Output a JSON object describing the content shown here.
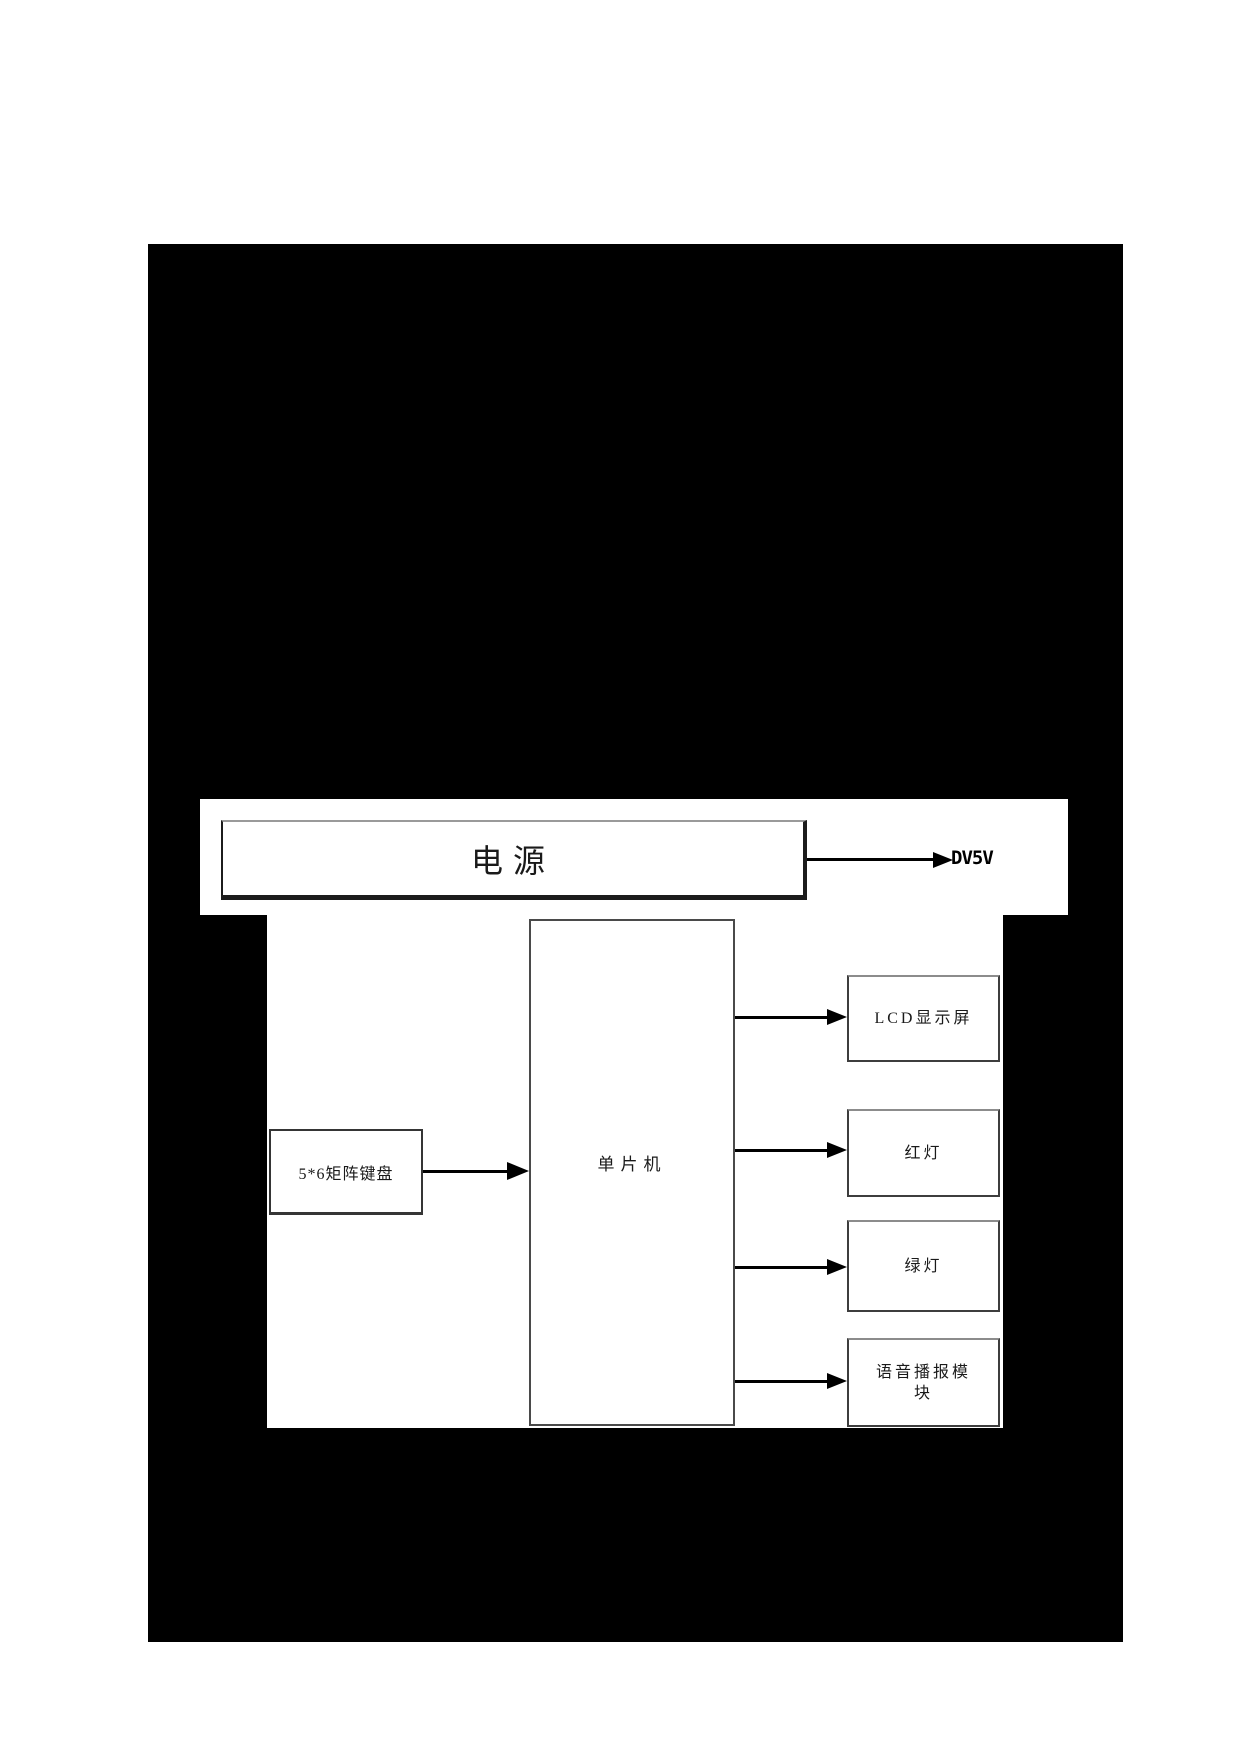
{
  "figure": {
    "power_box": {
      "label": "电源"
    },
    "power_output": {
      "label": "DV5V"
    },
    "keyboard_box": {
      "label": "5*6矩阵键盘"
    },
    "mcu_box": {
      "label": "单片机"
    },
    "output_boxes": [
      {
        "label": "LCD显示屏"
      },
      {
        "label": "红灯"
      },
      {
        "label": "绿灯"
      },
      {
        "label": "语音播报模块"
      }
    ],
    "colors": {
      "page_background": "#ffffff",
      "figure_background": "#000000",
      "box_background": "#ffffff",
      "box_border": "#3d3d3d",
      "line_color": "#000000",
      "text_color": "#1a1a1a"
    }
  }
}
